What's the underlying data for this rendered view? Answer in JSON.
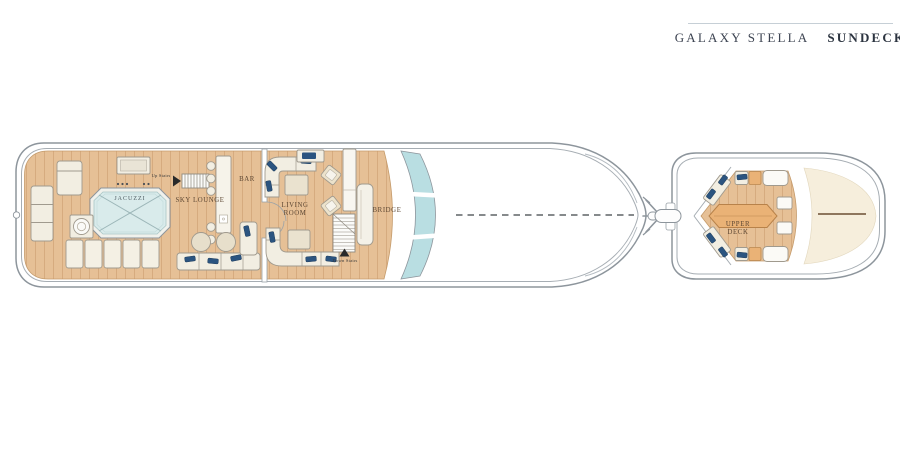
{
  "header": {
    "yacht_name": "GALAXY STELLA",
    "deck_name": "SUNDECK"
  },
  "plan": {
    "rooms": {
      "jacuzzi": "JACUZZI",
      "sky_lounge": "SKY LOUNGE",
      "bar": "BAR",
      "living_room": "LIVING ROOM",
      "bridge": "BRIDGE",
      "upper_deck": "UPPER DECK"
    },
    "annotations": {
      "up_stairs": "Up Stairs",
      "down_stairs": "Down Stairs"
    }
  },
  "colors": {
    "accent_separator": "#2f6f9c",
    "title_text": "#3d4452",
    "hull_outline": "#8d959c",
    "deck_wood": "#e6c096",
    "plank_line": "#d3a679",
    "jacuzzi_water": "#d9ebeb",
    "windshield_glass": "#b9dee2",
    "furniture_cream": "#f2eee2",
    "pillow_blue": "#2b5480",
    "table_wood": "#eab276",
    "foredeck_cream": "#f6eedc",
    "label_text": "#5d4733"
  }
}
